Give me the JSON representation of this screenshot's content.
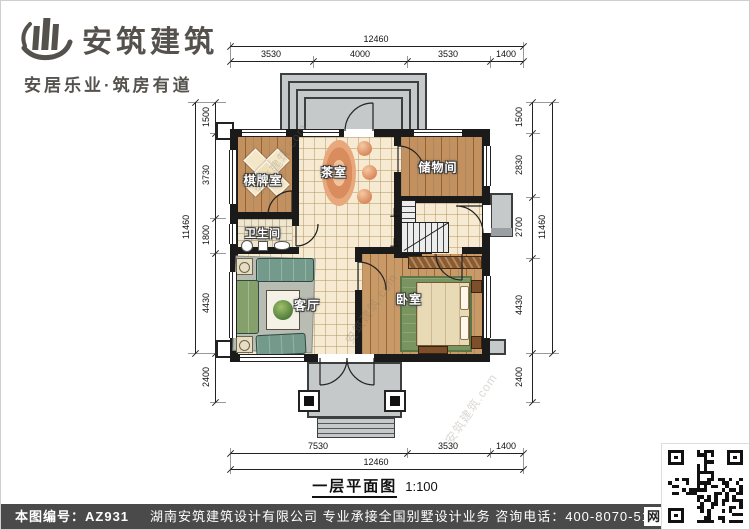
{
  "logo": {
    "title": "安筑建筑",
    "tagline": "安居乐业·筑房有道"
  },
  "watermark": {
    "text": "安筑建筑.com"
  },
  "plan": {
    "title": "一层平面图",
    "scale_label": "1:100",
    "stair_label": "上",
    "rooms": [
      {
        "id": "chess",
        "label": "棋牌室"
      },
      {
        "id": "tea",
        "label": "茶室"
      },
      {
        "id": "storage",
        "label": "储物间"
      },
      {
        "id": "bath",
        "label": "卫生间"
      },
      {
        "id": "living",
        "label": "客厅"
      },
      {
        "id": "bedroom",
        "label": "卧室"
      }
    ],
    "dims": {
      "top_total": "12460",
      "top_segments": [
        "3530",
        "4000",
        "3530",
        "1400"
      ],
      "bottom_segments": [
        "7530",
        "3530",
        "1400"
      ],
      "bottom_total": "12460",
      "left_total": "11460",
      "left_segments": [
        "1500",
        "3730",
        "1800",
        "4430",
        "2400"
      ],
      "right_total": "11460",
      "right_segments": [
        "1500",
        "2830",
        "2700",
        "4430",
        "2400"
      ]
    }
  },
  "footer": {
    "doc_label": "本图编号：",
    "doc_no": "AZ931",
    "company_line": "湖南安筑建筑设计有限公司  专业承接全国别墅设计业务  咨询电话：400-8070-511",
    "net_label": "网"
  },
  "colors": {
    "wall": "#1a1a1a",
    "wood": "#c2915f",
    "tile": "#f6ead2",
    "porch": "#c5c9ca",
    "footer_bar": "#4a4a4a",
    "logo": "#55524e"
  }
}
